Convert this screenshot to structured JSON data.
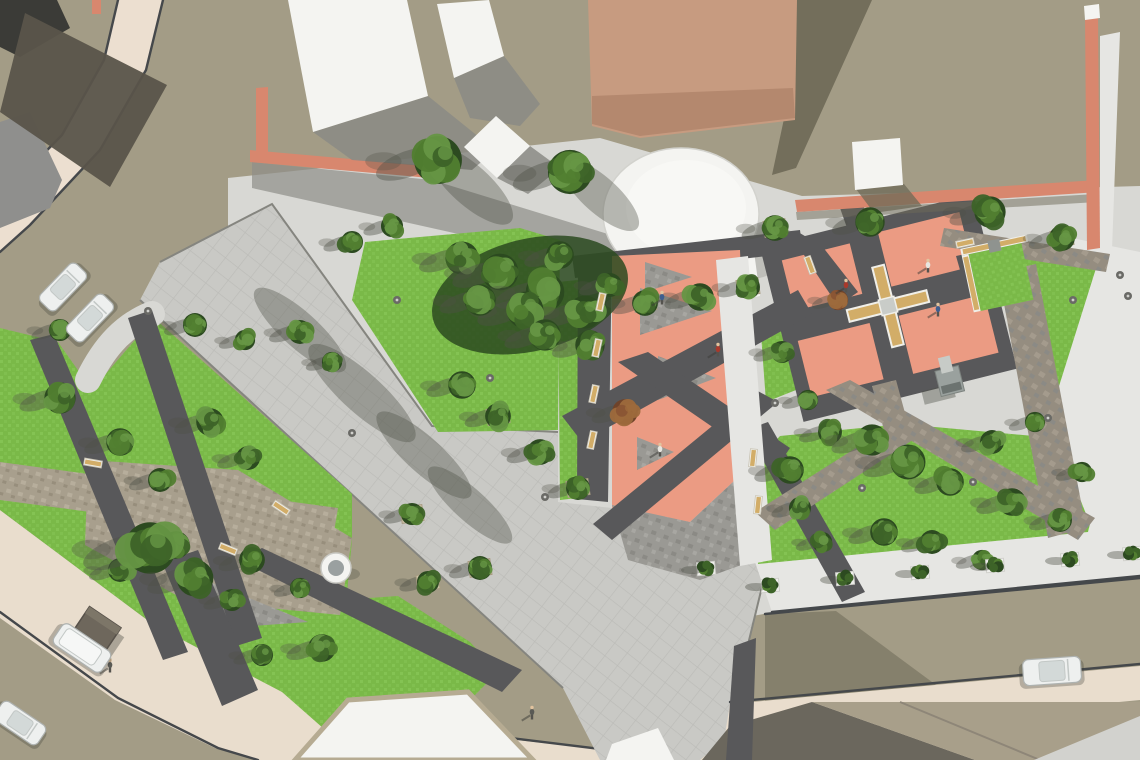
{
  "scene": {
    "title": "Aerial 3D architectural render of an urban plaza and park redesign",
    "width": 1140,
    "height": 760
  },
  "colors": {
    "ground": "#a39c86",
    "groundShadow": "#6e6957",
    "road": "#ecdfd0",
    "roadCream": "#e9ddcd",
    "curb": "#45484b",
    "apron": "#d8d8d4",
    "sidewalk": "#e6e6e3",
    "walk": "#c9c9c5",
    "walkLine": "#bbbbb7",
    "walkEdge": "#85857f",
    "granite": "#9a9994",
    "graniteDark": "#8b8a85",
    "graniteLight": "#a8a7a2",
    "stone": "#958d80",
    "stoneLight": "#a49b8d",
    "pathDark": "#58585a",
    "lawn": "#7ab948",
    "lawnLight": "#84c353",
    "treeDark": "#2c4a20",
    "treeMid": "#3d6328",
    "treeLight": "#517e30",
    "treePale": "#669645",
    "treeRed1": "#6f432a",
    "treeRed2": "#8a5534",
    "treeRed3": "#9d6a3c",
    "trunk": "#7b4a28",
    "salmon": "#eb9b83",
    "wallSalmon": "#d8876e",
    "buildingWhite": "#f4f4f1",
    "buildingShade": "#dededa",
    "buildingTan": "#c79b80",
    "buildingTanDark": "#b4886e",
    "roofDark": "#6b675d",
    "roofKhaki": "#a89f8a",
    "roofGray": "#5a544a",
    "grayBuilding": "#8f8f8d",
    "benchTan": "#d2ad68",
    "benchWhite": "#f0efe9",
    "planterTan": "#cdc2a8",
    "shadow": "#4e5147",
    "carBody": "#eef0ef",
    "carShade": "#c3c8c6",
    "carGlass": "#d3d9d8",
    "kiosk": "#6e675c",
    "fountainGray": "#9aa0a0",
    "floor": "#bcbcb7",
    "bpTan": "#a89f8d",
    "skin": "#e2c39e"
  },
  "trees": [
    [
      438,
      160,
      26,
      0
    ],
    [
      570,
      172,
      24,
      0
    ],
    [
      645,
      303,
      14,
      2
    ],
    [
      700,
      297,
      15,
      2
    ],
    [
      748,
      287,
      13,
      2
    ],
    [
      775,
      228,
      14,
      2
    ],
    [
      870,
      222,
      16,
      2
    ],
    [
      990,
      212,
      17,
      2
    ],
    [
      1062,
      238,
      14,
      2
    ],
    [
      462,
      258,
      18,
      0
    ],
    [
      500,
      272,
      20,
      0
    ],
    [
      545,
      292,
      21,
      0
    ],
    [
      585,
      312,
      18,
      0
    ],
    [
      525,
      310,
      20,
      0
    ],
    [
      480,
      300,
      17,
      0
    ],
    [
      560,
      255,
      15,
      0
    ],
    [
      610,
      285,
      13,
      0
    ],
    [
      590,
      345,
      16,
      0
    ],
    [
      545,
      335,
      17,
      0
    ],
    [
      352,
      242,
      12,
      0
    ],
    [
      392,
      226,
      12,
      0
    ],
    [
      625,
      412,
      14,
      1
    ],
    [
      838,
      300,
      11,
      1
    ],
    [
      462,
      385,
      15,
      2
    ],
    [
      498,
      416,
      14,
      2
    ],
    [
      540,
      452,
      14,
      2
    ],
    [
      578,
      488,
      13,
      2
    ],
    [
      480,
      568,
      13,
      2
    ],
    [
      428,
      582,
      12,
      2
    ],
    [
      412,
      514,
      12,
      2
    ],
    [
      60,
      398,
      17,
      0
    ],
    [
      120,
      442,
      15,
      0
    ],
    [
      160,
      480,
      13,
      0
    ],
    [
      210,
      422,
      15,
      0
    ],
    [
      248,
      458,
      13,
      0
    ],
    [
      176,
      545,
      15,
      0
    ],
    [
      120,
      570,
      13,
      0
    ],
    [
      252,
      560,
      14,
      0
    ],
    [
      232,
      600,
      12,
      0
    ],
    [
      300,
      588,
      11,
      0
    ],
    [
      195,
      325,
      13,
      0
    ],
    [
      245,
      340,
      11,
      0
    ],
    [
      300,
      332,
      13,
      0
    ],
    [
      332,
      362,
      11,
      0
    ],
    [
      60,
      330,
      12,
      0
    ],
    [
      150,
      548,
      28,
      0
    ],
    [
      195,
      578,
      20,
      0
    ],
    [
      322,
      648,
      15,
      0
    ],
    [
      262,
      655,
      12,
      0
    ],
    [
      790,
      470,
      15,
      0
    ],
    [
      830,
      432,
      13,
      0
    ],
    [
      872,
      440,
      17,
      0
    ],
    [
      908,
      462,
      19,
      0
    ],
    [
      950,
      482,
      15,
      0
    ],
    [
      992,
      442,
      13,
      0
    ],
    [
      1012,
      502,
      15,
      0
    ],
    [
      1060,
      520,
      13,
      0
    ],
    [
      884,
      532,
      15,
      0
    ],
    [
      932,
      542,
      13,
      0
    ],
    [
      822,
      542,
      11,
      0
    ],
    [
      982,
      560,
      11,
      0
    ],
    [
      1035,
      422,
      11,
      0
    ],
    [
      1082,
      472,
      11,
      0
    ],
    [
      800,
      508,
      12,
      0
    ],
    [
      782,
      352,
      12,
      0
    ],
    [
      808,
      400,
      11,
      0
    ]
  ],
  "shrubs": [
    [
      770,
      585
    ],
    [
      845,
      578
    ],
    [
      920,
      572
    ],
    [
      995,
      565
    ],
    [
      1070,
      559
    ],
    [
      1132,
      553
    ],
    [
      706,
      568
    ]
  ],
  "benches": [
    [
      601,
      302,
      -78
    ],
    [
      597,
      348,
      -78
    ],
    [
      594,
      394,
      -78
    ],
    [
      592,
      440,
      -78
    ],
    [
      753,
      458,
      -84
    ],
    [
      758,
      505,
      -84
    ],
    [
      93,
      463,
      10
    ],
    [
      228,
      549,
      22
    ],
    [
      281,
      508,
      34
    ],
    [
      810,
      265,
      70
    ],
    [
      965,
      243,
      -12
    ]
  ],
  "lamps": [
    [
      148,
      311
    ],
    [
      397,
      300
    ],
    [
      490,
      378
    ],
    [
      775,
      403
    ],
    [
      973,
      482
    ],
    [
      1048,
      418
    ],
    [
      1120,
      275
    ],
    [
      1128,
      296
    ],
    [
      1073,
      300
    ],
    [
      862,
      488
    ],
    [
      545,
      497
    ],
    [
      352,
      433
    ]
  ],
  "people": [
    [
      662,
      300,
      "#3f5e8e"
    ],
    [
      718,
      352,
      "#a8392c"
    ],
    [
      660,
      452,
      "#e8e6e0"
    ],
    [
      846,
      288,
      "#a8392c"
    ],
    [
      928,
      268,
      "#e8e6e0"
    ],
    [
      938,
      312,
      "#3f5e8e"
    ],
    [
      110,
      668,
      "#5a5a55"
    ],
    [
      532,
      715,
      "#5a5a55"
    ]
  ],
  "cars": [
    [
      63,
      287,
      -46,
      52,
      22,
      "car"
    ],
    [
      90,
      318,
      -46,
      52,
      22,
      "car"
    ],
    [
      82,
      648,
      34,
      58,
      25,
      "van"
    ],
    [
      20,
      723,
      34,
      52,
      23,
      "car"
    ],
    [
      1052,
      671,
      -4,
      58,
      26,
      "car"
    ]
  ],
  "plaza_triangles": [
    [
      640,
      288,
      640,
      335,
      712,
      311
    ],
    [
      658,
      356,
      658,
      400,
      716,
      378
    ],
    [
      637,
      437,
      637,
      470,
      674,
      452
    ],
    [
      645,
      262,
      645,
      292,
      692,
      277
    ]
  ],
  "walkway_shadows": [
    [
      300,
      330,
      60,
      18
    ],
    [
      362,
      393,
      70,
      20
    ],
    [
      424,
      455,
      62,
      18
    ],
    [
      470,
      505,
      55,
      16
    ],
    [
      470,
      185,
      55,
      20
    ],
    [
      600,
      195,
      50,
      18
    ]
  ]
}
